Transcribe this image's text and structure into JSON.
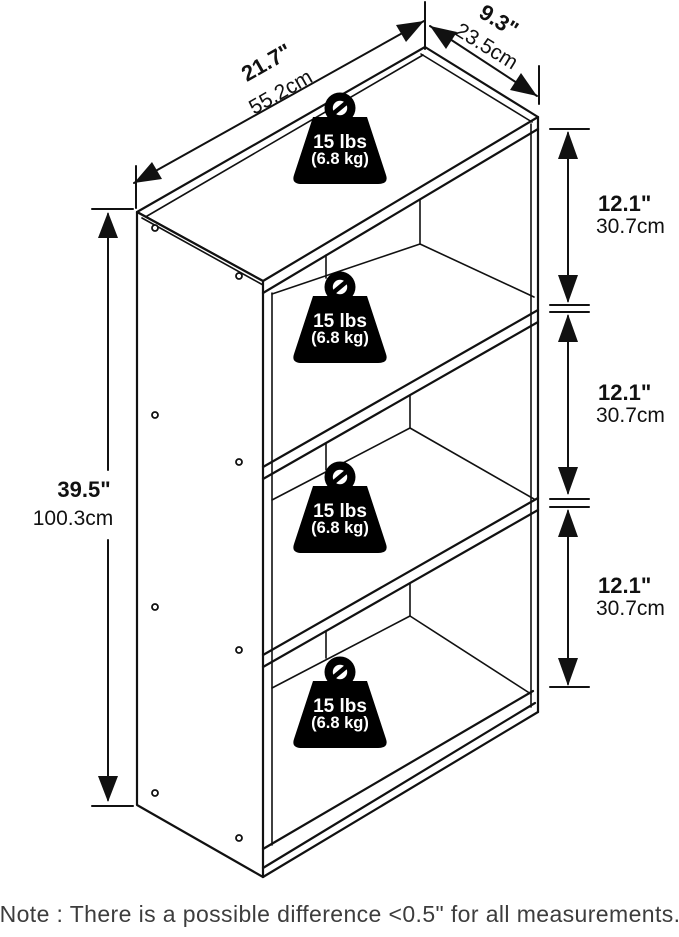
{
  "diagram": {
    "width": {
      "inches": "21.7\"",
      "cm": "55.2cm"
    },
    "depth": {
      "inches": "9.3\"",
      "cm": "23.5cm"
    },
    "height": {
      "inches": "39.5\"",
      "cm": "100.3cm"
    },
    "spacings": [
      {
        "inches": "12.1\"",
        "cm": "30.7cm"
      },
      {
        "inches": "12.1\"",
        "cm": "30.7cm"
      },
      {
        "inches": "12.1\"",
        "cm": "30.7cm"
      }
    ],
    "weights": [
      {
        "pounds": "15 lbs",
        "kilograms": "(6.8 kg)"
      },
      {
        "pounds": "15 lbs",
        "kilograms": "(6.8 kg)"
      },
      {
        "pounds": "15 lbs",
        "kilograms": "(6.8 kg)"
      },
      {
        "pounds": "15 lbs",
        "kilograms": "(6.8 kg)"
      }
    ],
    "note": "Note : There is a possible difference <0.5\" for all measurements.",
    "colors": {
      "line": "#111111",
      "background": "#ffffff",
      "weight_fill": "#000000",
      "weight_text": "#ffffff",
      "note_text": "#3d3d3d"
    }
  }
}
